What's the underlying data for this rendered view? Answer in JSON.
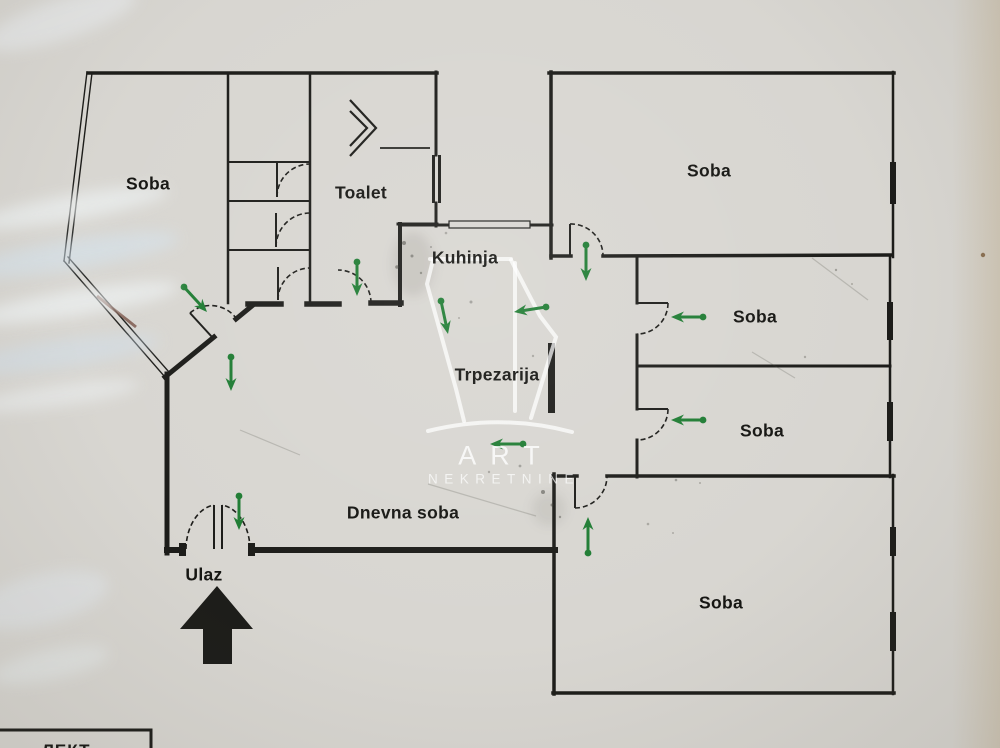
{
  "colors": {
    "paper": "#d8d6d1",
    "wall": "#1c1c19",
    "arrow_green": "#1f7c33",
    "label": "#151512"
  },
  "rooms": [
    {
      "name": "soba-top-left",
      "text": "Soba",
      "x": 148,
      "y": 184
    },
    {
      "name": "toalet",
      "text": "Toalet",
      "x": 361,
      "y": 193
    },
    {
      "name": "kuhinja",
      "text": "Kuhinja",
      "x": 465,
      "y": 258
    },
    {
      "name": "trpezarija",
      "text": "Trpezarija",
      "x": 497,
      "y": 375
    },
    {
      "name": "dnevna-soba",
      "text": "Dnevna soba",
      "x": 403,
      "y": 513
    },
    {
      "name": "soba-top-right",
      "text": "Soba",
      "x": 709,
      "y": 171
    },
    {
      "name": "soba-middle-upper",
      "text": "Soba",
      "x": 755,
      "y": 317
    },
    {
      "name": "soba-middle-lower",
      "text": "Soba",
      "x": 762,
      "y": 431
    },
    {
      "name": "soba-bottom-right",
      "text": "Soba",
      "x": 721,
      "y": 603
    },
    {
      "name": "ulaz",
      "text": "Ulaz",
      "x": 204,
      "y": 575
    }
  ],
  "watermark": {
    "line1": "ART",
    "line2": "NEKRETNINE"
  },
  "legend": {
    "partial_text": "ЛЕКТ"
  },
  "arrows": [
    {
      "dir": "down-right",
      "x1": 184,
      "y1": 287,
      "x2": 207,
      "y2": 312
    },
    {
      "dir": "down",
      "x1": 231,
      "y1": 357,
      "x2": 231,
      "y2": 391
    },
    {
      "dir": "down",
      "x1": 357,
      "y1": 262,
      "x2": 357,
      "y2": 296
    },
    {
      "dir": "down",
      "x1": 586,
      "y1": 245,
      "x2": 586,
      "y2": 281
    },
    {
      "dir": "down",
      "x1": 441,
      "y1": 301,
      "x2": 448,
      "y2": 334
    },
    {
      "dir": "left",
      "x1": 546,
      "y1": 307,
      "x2": 514,
      "y2": 312
    },
    {
      "dir": "left",
      "x1": 523,
      "y1": 444,
      "x2": 490,
      "y2": 444
    },
    {
      "dir": "left",
      "x1": 703,
      "y1": 317,
      "x2": 671,
      "y2": 317
    },
    {
      "dir": "left",
      "x1": 703,
      "y1": 420,
      "x2": 671,
      "y2": 420
    },
    {
      "dir": "up",
      "x1": 588,
      "y1": 553,
      "x2": 588,
      "y2": 517
    },
    {
      "dir": "down",
      "x1": 239,
      "y1": 496,
      "x2": 239,
      "y2": 530
    }
  ]
}
